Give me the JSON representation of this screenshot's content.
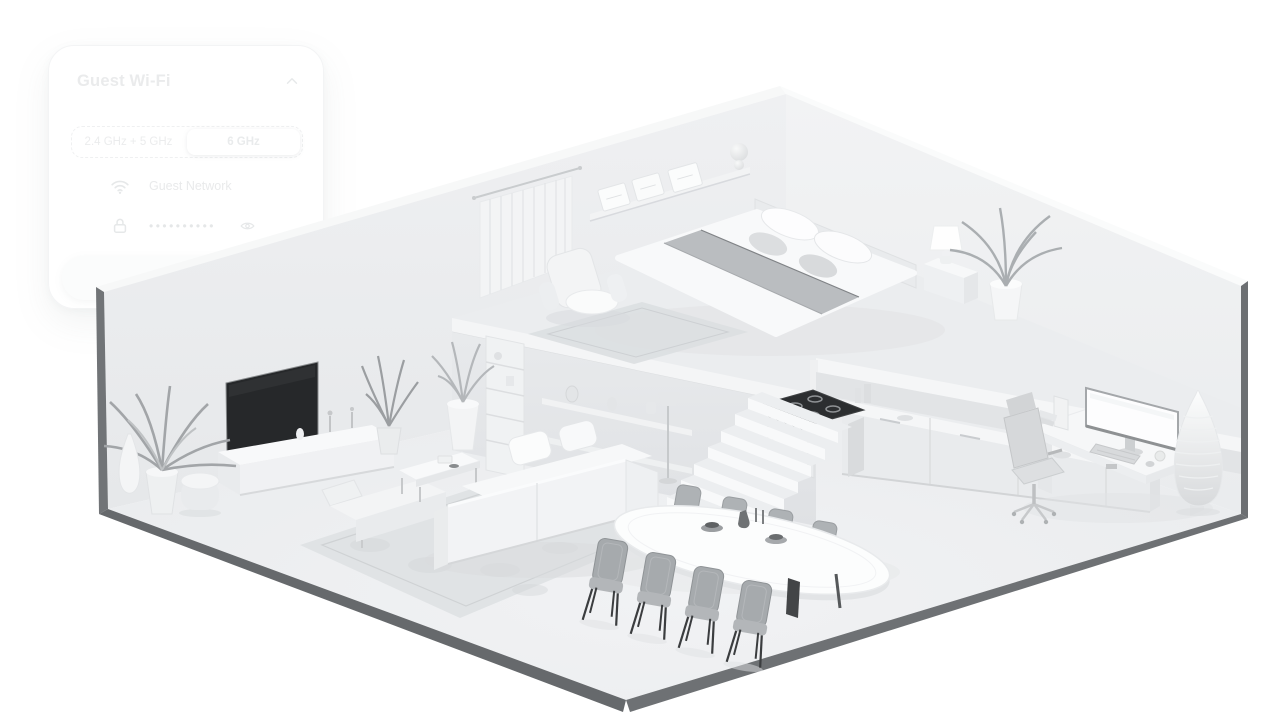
{
  "card": {
    "title": "Guest Wi-Fi",
    "collapse_icon": "chevron-up",
    "band_selector": {
      "options": [
        "2.4 GHz + 5 GHz",
        "6 GHz"
      ],
      "selected": "6 GHz"
    },
    "network_row": {
      "icon": "wifi",
      "label": "Guest Network"
    },
    "password_row": {
      "icon": "lock",
      "masked_value": "••••••••••",
      "visibility_icon": "eye"
    },
    "share_button_label": "Share"
  },
  "scene": {
    "type": "isometric-home-cutaway",
    "areas": [
      "bedroom-loft",
      "kitchen",
      "stairs",
      "living-room",
      "dining-area",
      "home-office"
    ],
    "colors": {
      "background": "#ffffff",
      "wall": "#e9ebed",
      "floor": "#edeff1",
      "outer_edge": "#6e7174",
      "tv_screen": "#26282a",
      "stove_cooktop": "#2c2e30",
      "dining_chair": "#a6aaad",
      "bed_blanket": "#babdc0"
    }
  }
}
